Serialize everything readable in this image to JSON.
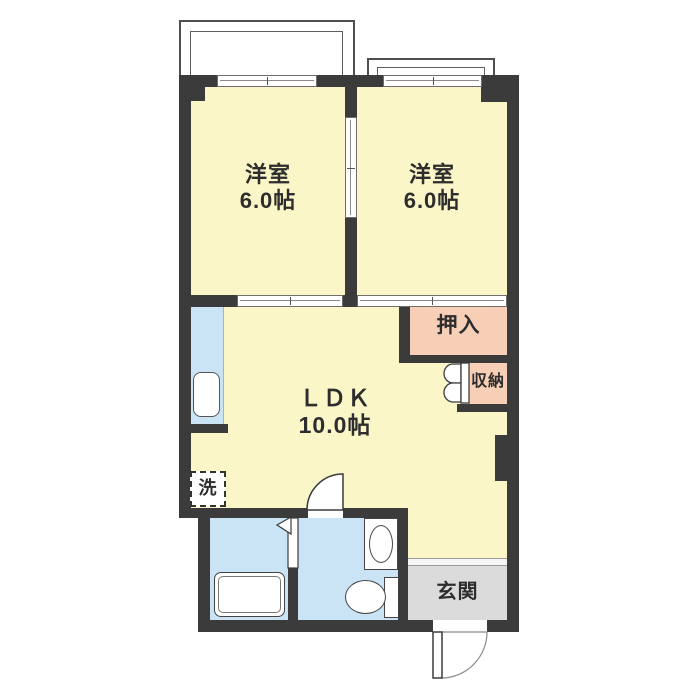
{
  "title": "apartment-floor-plan",
  "colors": {
    "wall": "#3b3b3b",
    "room_yellow": "#faf6c8",
    "closet_pink": "#f7ceb6",
    "water_blue": "#cae3f5",
    "entrance_gray": "#dbdbdb",
    "balcony_line": "#4f4f4f",
    "fixture_line": "#444444",
    "text": "#2d2d2d"
  },
  "rooms": {
    "bedroom1": {
      "label": "洋室",
      "size": "6.0帖"
    },
    "bedroom2": {
      "label": "洋室",
      "size": "6.0帖"
    },
    "ldk": {
      "label": "ＬＤＫ",
      "size": "10.0帖"
    },
    "oshiire": {
      "label": "押入"
    },
    "storage": {
      "label": "収納"
    },
    "entrance": {
      "label": "玄関"
    },
    "laundry": {
      "label": "洗"
    }
  },
  "fixtures": {
    "items": [
      "balcony",
      "balcony",
      "sliding-window",
      "sliding-window",
      "sliding-door-between-bedrooms",
      "fusuma-sliding-door",
      "fusuma-sliding-door",
      "kitchen-sink",
      "washing-machine-space",
      "bathtub",
      "folding-bath-door",
      "wash-basin",
      "toilet",
      "bifold-closet-door",
      "hinged-washroom-door",
      "entrance-swing-door"
    ]
  }
}
